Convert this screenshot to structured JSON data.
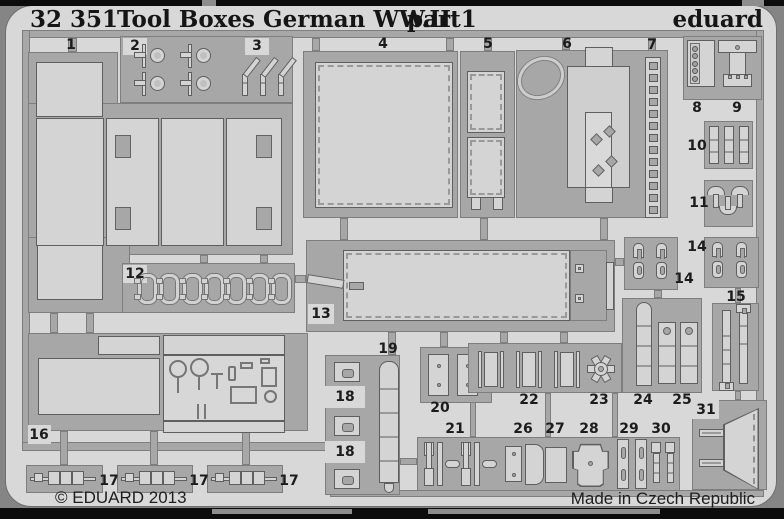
{
  "header": {
    "catalog_no": "32 351",
    "title": "Tool Boxes German WW.II",
    "part_label": "part1",
    "brand": "eduard"
  },
  "footer": {
    "copyright": "© EDUARD 2013",
    "made_in": "Made in Czech Republic"
  },
  "colors": {
    "sheet": "#d8d8d8",
    "metal_runner": "#a7a7a7",
    "part_fill": "#d4d4d4",
    "outline": "#5f5f5f",
    "photo_background": "#0c0c0c",
    "text": "#151515"
  },
  "detail_counts": {
    "part2_latches": 4,
    "part3_hinges": 3,
    "part7_ladder_holes": 13,
    "part10_strips": 3,
    "part11_caps": 3,
    "part12_clips": 7,
    "part17_straps": 3,
    "part22_links": 3
  },
  "part_labels": [
    {
      "t": "1",
      "x": 71,
      "y": 45,
      "notch": false
    },
    {
      "t": "2",
      "x": 135,
      "y": 46,
      "notch": true
    },
    {
      "t": "3",
      "x": 257,
      "y": 46,
      "notch": true
    },
    {
      "t": "4",
      "x": 383,
      "y": 44,
      "notch": false
    },
    {
      "t": "5",
      "x": 488,
      "y": 44,
      "notch": false
    },
    {
      "t": "6",
      "x": 567,
      "y": 44,
      "notch": false
    },
    {
      "t": "7",
      "x": 652,
      "y": 45,
      "notch": false
    },
    {
      "t": "8",
      "x": 697,
      "y": 108,
      "notch": false
    },
    {
      "t": "9",
      "x": 737,
      "y": 108,
      "notch": false
    },
    {
      "t": "10",
      "x": 697,
      "y": 146,
      "notch": false
    },
    {
      "t": "11",
      "x": 699,
      "y": 203,
      "notch": false
    },
    {
      "t": "12",
      "x": 135,
      "y": 274,
      "notch": true
    },
    {
      "t": "13",
      "x": 321,
      "y": 314,
      "notch": true
    },
    {
      "t": "14",
      "x": 697,
      "y": 247,
      "notch": false
    },
    {
      "t": "14",
      "x": 684,
      "y": 279,
      "notch": false
    },
    {
      "t": "15",
      "x": 736,
      "y": 297,
      "notch": false
    },
    {
      "t": "16",
      "x": 39,
      "y": 435,
      "notch": true
    },
    {
      "t": "17",
      "x": 109,
      "y": 481,
      "notch": false
    },
    {
      "t": "17",
      "x": 199,
      "y": 481,
      "notch": false
    },
    {
      "t": "17",
      "x": 289,
      "y": 481,
      "notch": false
    },
    {
      "t": "18",
      "x": 345,
      "y": 397,
      "notch": true
    },
    {
      "t": "18",
      "x": 345,
      "y": 452,
      "notch": true
    },
    {
      "t": "19",
      "x": 388,
      "y": 349,
      "notch": false
    },
    {
      "t": "20",
      "x": 440,
      "y": 408,
      "notch": false
    },
    {
      "t": "21",
      "x": 455,
      "y": 429,
      "notch": false
    },
    {
      "t": "22",
      "x": 529,
      "y": 400,
      "notch": false
    },
    {
      "t": "23",
      "x": 599,
      "y": 400,
      "notch": false
    },
    {
      "t": "24",
      "x": 643,
      "y": 400,
      "notch": false
    },
    {
      "t": "25",
      "x": 682,
      "y": 400,
      "notch": false
    },
    {
      "t": "26",
      "x": 523,
      "y": 429,
      "notch": false
    },
    {
      "t": "27",
      "x": 555,
      "y": 429,
      "notch": false
    },
    {
      "t": "28",
      "x": 589,
      "y": 429,
      "notch": false
    },
    {
      "t": "29",
      "x": 629,
      "y": 429,
      "notch": false
    },
    {
      "t": "30",
      "x": 661,
      "y": 429,
      "notch": false
    },
    {
      "t": "31",
      "x": 706,
      "y": 410,
      "notch": true
    }
  ]
}
